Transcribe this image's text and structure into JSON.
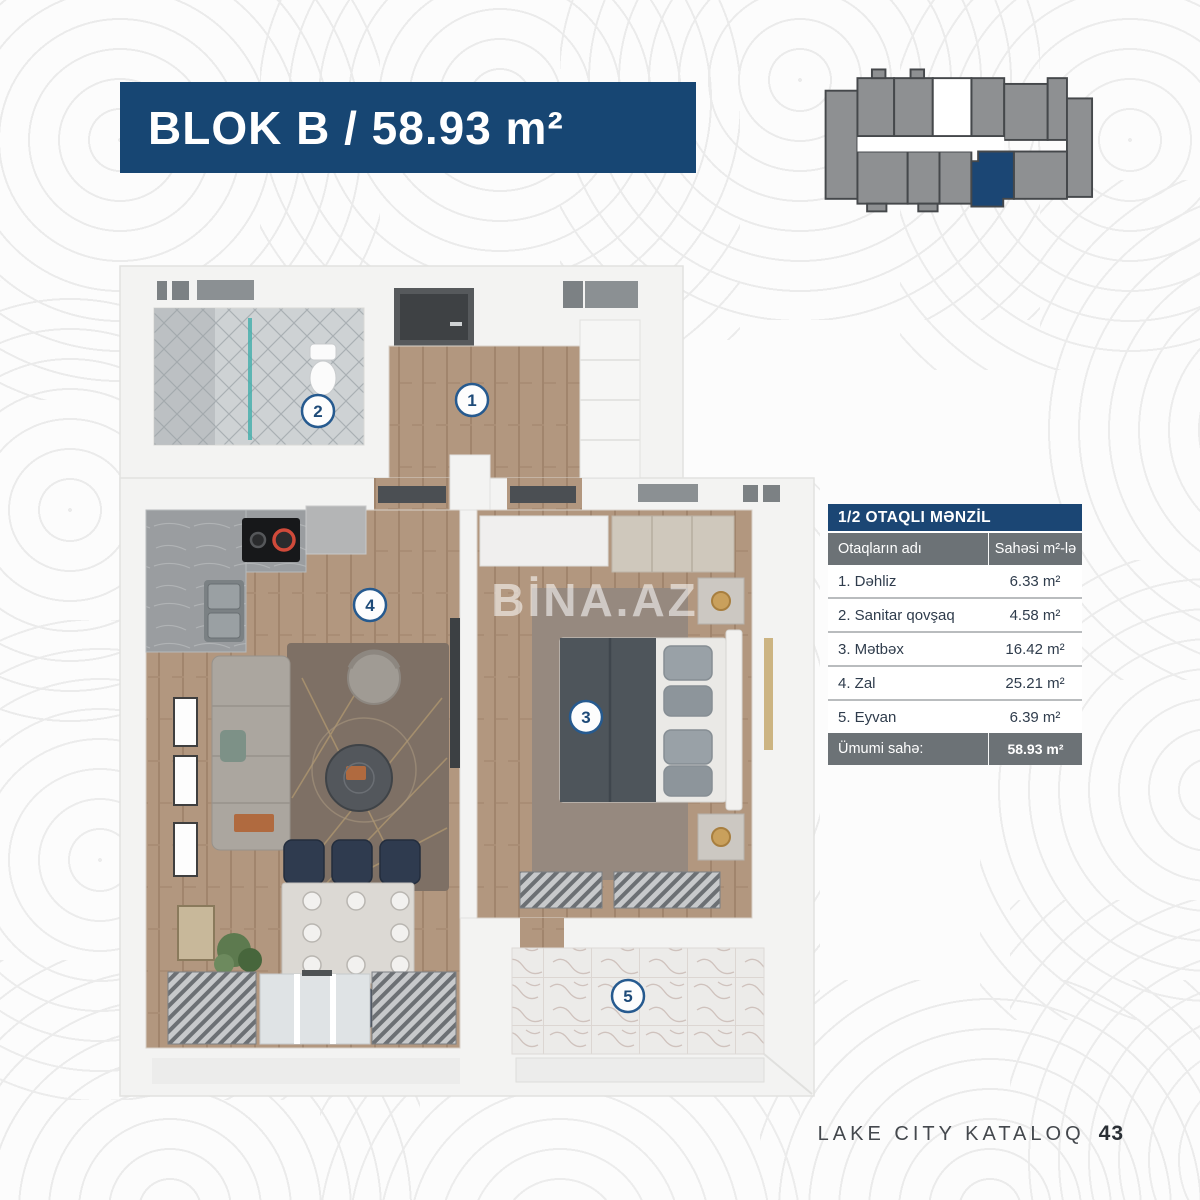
{
  "banner": {
    "title": "BLOK B / 58.93 m²"
  },
  "key_plan": {
    "description": "building-level key plan with highlighted unit",
    "unit_color": "#8e9092",
    "highlight_color": "#1b4674"
  },
  "floor_plan": {
    "watermark": "BİNA.AZ",
    "badges": [
      {
        "number": "1"
      },
      {
        "number": "2"
      },
      {
        "number": "3"
      },
      {
        "number": "4"
      },
      {
        "number": "5"
      }
    ]
  },
  "area_table": {
    "title": "1/2 OTAQLI MƏNZİL",
    "columns": {
      "name": "Otaqların adı",
      "area": "Sahəsi m²-lə"
    },
    "rows": [
      {
        "name": "1. Dəhliz",
        "area": "6.33 m²"
      },
      {
        "name": "2. Sanitar qovşaq",
        "area": "4.58 m²"
      },
      {
        "name": "3. Mətbəx",
        "area": "16.42 m²"
      },
      {
        "name": "4. Zal",
        "area": "25.21 m²"
      },
      {
        "name": "5. Eyvan",
        "area": "6.39 m²"
      }
    ],
    "total": {
      "name": "Ümumi sahə:",
      "area": "58.93 m²"
    }
  },
  "footer": {
    "brand": "LAKE CITY KATALOQ",
    "page": "43"
  },
  "colors": {
    "banner_navy": "#174673",
    "table_navy": "#1b4674",
    "table_gray": "#6c7276",
    "row_divider": "#b9bcbe"
  }
}
